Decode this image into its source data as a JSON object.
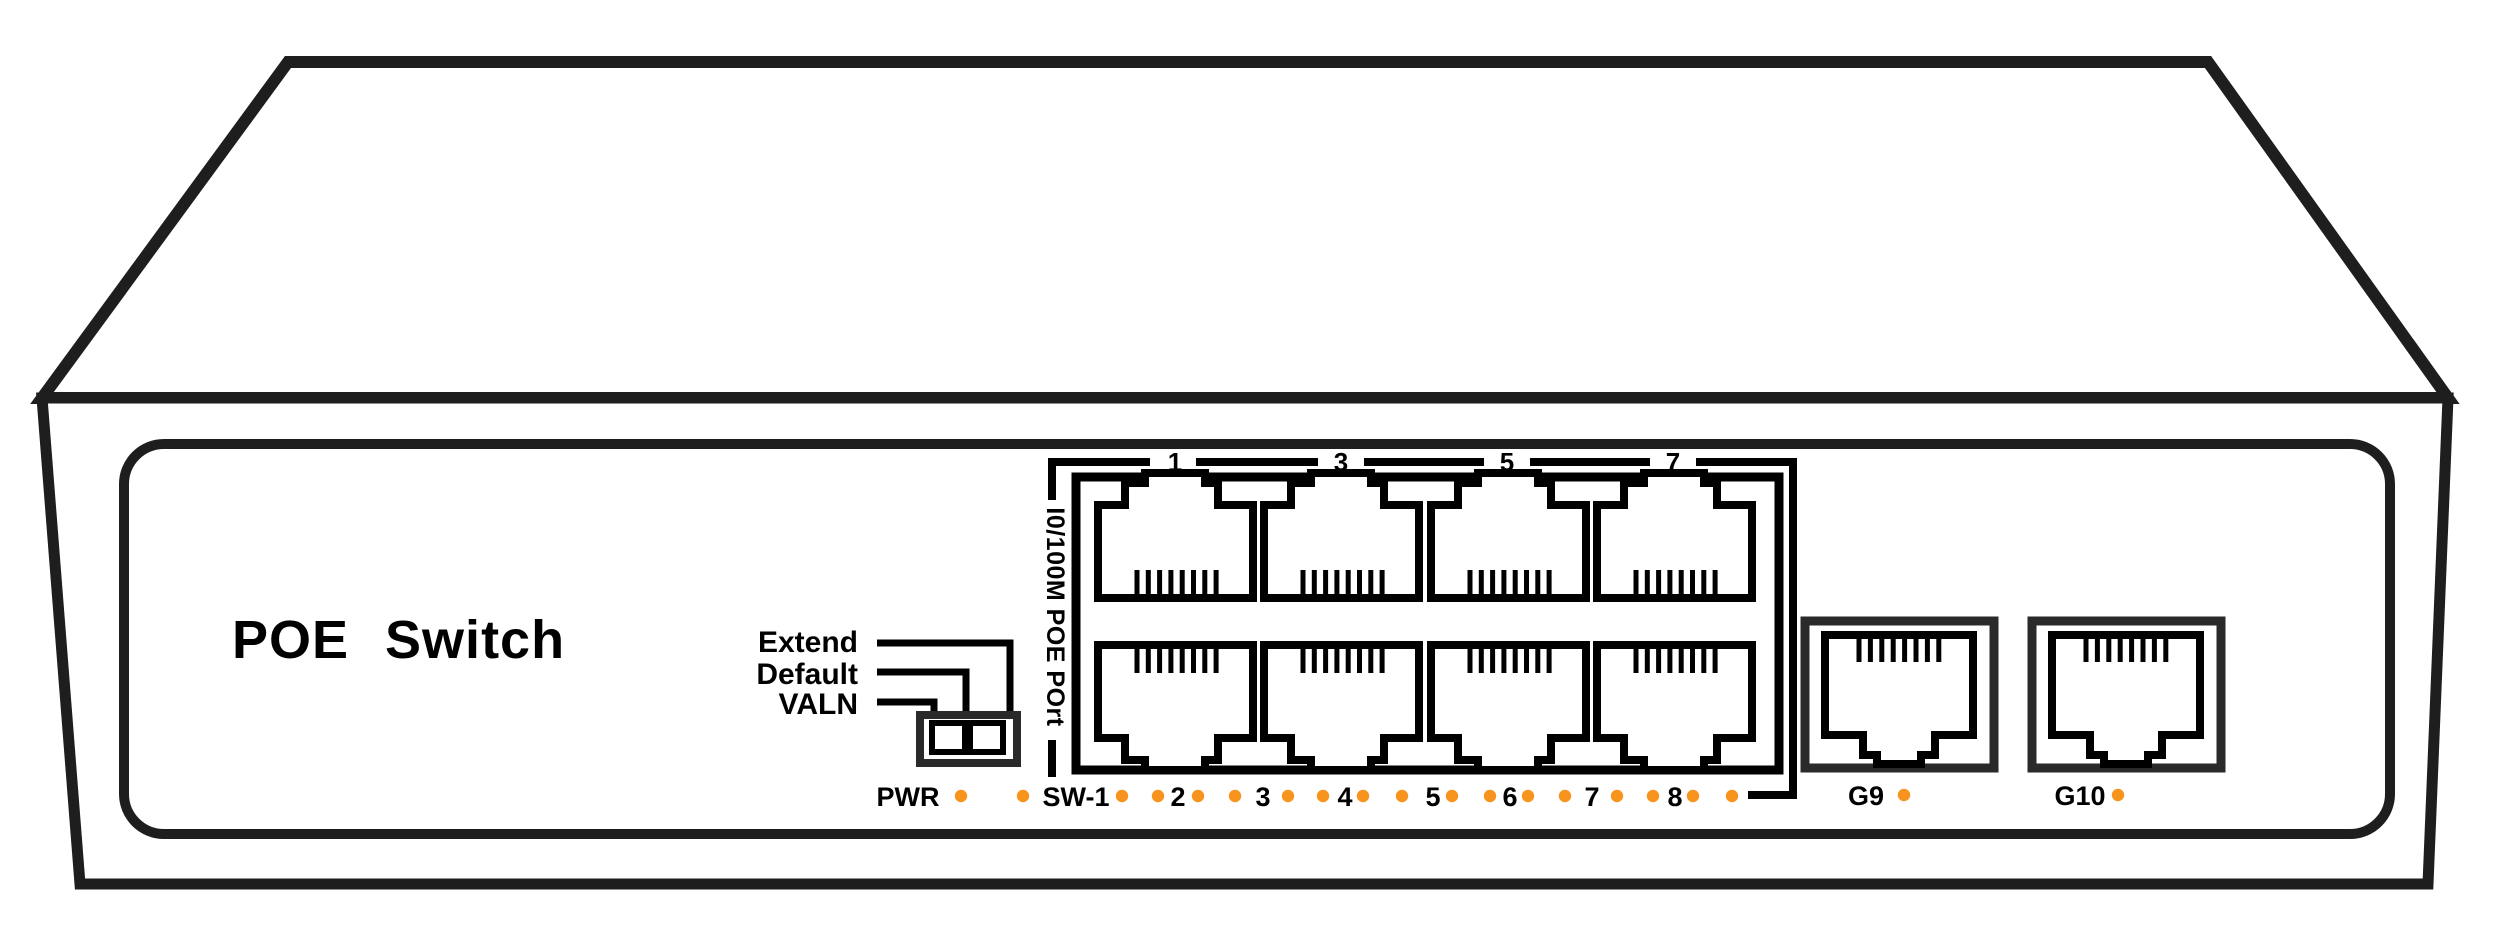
{
  "device": {
    "title": "POE Switch"
  },
  "dip_switch": {
    "labels": [
      "Extend",
      "Default",
      "VALN"
    ],
    "positions": 2
  },
  "poe_port_group": {
    "side_label": "I0/100M POE POrt",
    "top_port_numbers": [
      "1",
      "3",
      "5",
      "7"
    ],
    "port_count": 8,
    "rows": 2
  },
  "led_row": {
    "items": [
      {
        "type": "label",
        "text": "PWR",
        "x": 908
      },
      {
        "type": "dot",
        "x": 961
      },
      {
        "type": "dot",
        "x": 1023
      },
      {
        "type": "label",
        "text": "SW-1",
        "x": 1076
      },
      {
        "type": "dot",
        "x": 1122
      },
      {
        "type": "dot",
        "x": 1158
      },
      {
        "type": "label",
        "text": "2",
        "x": 1178
      },
      {
        "type": "dot",
        "x": 1198
      },
      {
        "type": "dot",
        "x": 1235
      },
      {
        "type": "label",
        "text": "3",
        "x": 1263
      },
      {
        "type": "dot",
        "x": 1288
      },
      {
        "type": "dot",
        "x": 1323
      },
      {
        "type": "label",
        "text": "4",
        "x": 1345
      },
      {
        "type": "dot",
        "x": 1363
      },
      {
        "type": "dot",
        "x": 1402
      },
      {
        "type": "label",
        "text": "5",
        "x": 1433
      },
      {
        "type": "dot",
        "x": 1452
      },
      {
        "type": "dot",
        "x": 1490
      },
      {
        "type": "label",
        "text": "6",
        "x": 1510
      },
      {
        "type": "dot",
        "x": 1528
      },
      {
        "type": "dot",
        "x": 1565
      },
      {
        "type": "label",
        "text": "7",
        "x": 1592
      },
      {
        "type": "dot",
        "x": 1617
      },
      {
        "type": "dot",
        "x": 1653
      },
      {
        "type": "label",
        "text": "8",
        "x": 1675
      },
      {
        "type": "dot",
        "x": 1693
      },
      {
        "type": "dot",
        "x": 1732
      }
    ]
  },
  "uplink_ports": [
    {
      "label": "G9",
      "x": 1805,
      "label_x": 1866,
      "dot_x": 1904
    },
    {
      "label": "G10",
      "x": 2032,
      "label_x": 2080,
      "dot_x": 2118
    }
  ],
  "colors": {
    "line": "#1e1e1e",
    "ink": "#000000",
    "led_orange": "#f7941e"
  }
}
